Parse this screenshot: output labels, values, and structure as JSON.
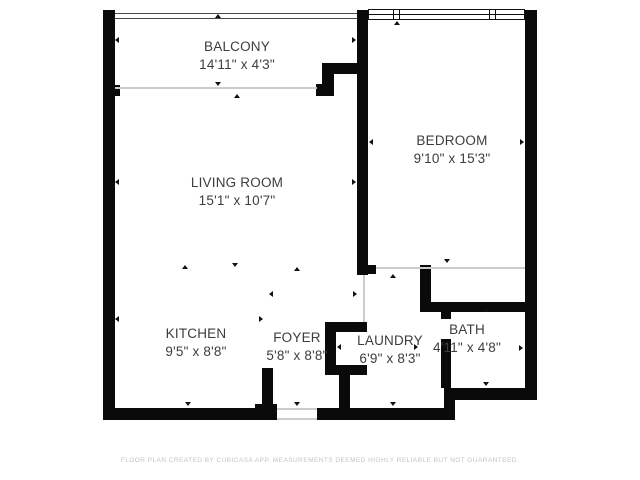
{
  "title": "Apartment floor plan",
  "rooms": [
    {
      "name": "BALCONY",
      "dimensions": "14'11\" x 4'3\""
    },
    {
      "name": "LIVING ROOM",
      "dimensions": "15'1\" x 10'7\""
    },
    {
      "name": "BEDROOM",
      "dimensions": "9'10\" x 15'3\""
    },
    {
      "name": "KITCHEN",
      "dimensions": "9'5\" x 8'8\""
    },
    {
      "name": "FOYER",
      "dimensions": "5'8\" x 8'8\""
    },
    {
      "name": "LAUNDRY",
      "dimensions": "6'9\" x 8'3\""
    },
    {
      "name": "BATH",
      "dimensions": "4'11\" x 4'8\""
    }
  ],
  "footer": {
    "disclaimer": "FLOOR PLAN CREATED BY CUBICASA APP. MEASUREMENTS DEEMED HIGHLY RELIABLE BUT NOT GUARANTEED."
  },
  "colors": {
    "background": "#ffffff",
    "wall": "#0a0a0a",
    "room_label": "#3d3d3d",
    "boundary_line": "#cccccc",
    "railing_line": "#4a4a4a",
    "disclaimer_text": "#c4c4c4"
  }
}
